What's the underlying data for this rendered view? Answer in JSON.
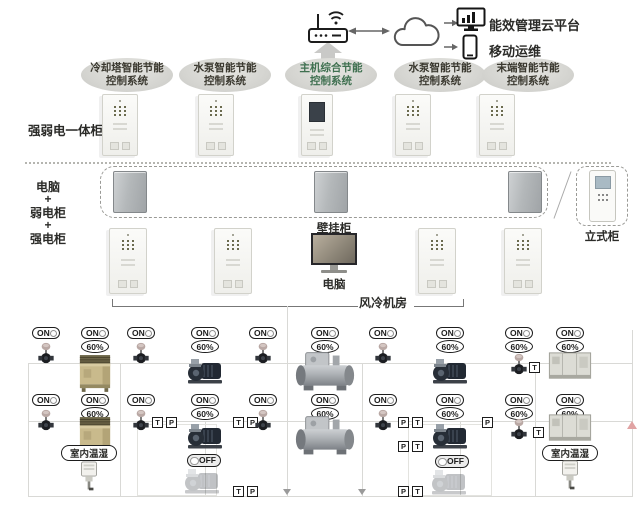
{
  "top": {
    "platform_label": "能效管理云平台",
    "mobile_label": "移动运维"
  },
  "systems": [
    {
      "line1": "冷却塔智能节能",
      "line2": "控制系统"
    },
    {
      "line1": "水泵智能节能",
      "line2": "控制系统"
    },
    {
      "line1": "主机综合节能",
      "line2": "控制系统"
    },
    {
      "line1": "水泵智能节能",
      "line2": "控制系统"
    },
    {
      "line1": "末端智能节能",
      "line2": "控制系统"
    }
  ],
  "labels": {
    "integrated_cabinet": "强弱电一体柜",
    "stack": [
      "电脑",
      "+",
      "弱电柜",
      "+",
      "强电柜"
    ],
    "wall_cabinet": "壁挂柜",
    "computer": "电脑",
    "standing_cabinet": "立式柜",
    "machine_room": "风冷机房"
  },
  "schematic": {
    "row1": [
      {
        "device": "valve",
        "state": "ON"
      },
      {
        "device": "cooling-tower",
        "state": "ON",
        "speed": "60%"
      },
      {
        "device": "valve",
        "state": "ON"
      },
      {
        "device": "pump",
        "state": "ON",
        "speed": "60%"
      },
      {
        "device": "valve",
        "state": "ON"
      },
      {
        "device": "chiller",
        "state": "ON",
        "speed": "60%"
      },
      {
        "device": "valve",
        "state": "ON"
      },
      {
        "device": "pump",
        "state": "ON",
        "speed": "60%"
      },
      {
        "device": "valve",
        "state": "ON",
        "speed": "60%",
        "tags": [
          "T"
        ]
      },
      {
        "device": "ahu",
        "state": "ON",
        "speed": "60%"
      }
    ],
    "row2": [
      {
        "device": "valve",
        "state": "ON"
      },
      {
        "device": "cooling-tower",
        "state": "ON",
        "speed": "60%"
      },
      {
        "device": "valve",
        "state": "ON",
        "tags": [
          "T",
          "P"
        ]
      },
      {
        "device": "pump",
        "state": "ON",
        "speed": "60%",
        "tags": [
          "T",
          "P"
        ]
      },
      {
        "device": "valve",
        "state": "ON"
      },
      {
        "device": "chiller",
        "state": "ON",
        "speed": "60%"
      },
      {
        "device": "valve",
        "state": "ON"
      },
      {
        "device": "pump",
        "state": "ON",
        "speed": "60%",
        "tags_left": [
          "P",
          "T"
        ],
        "tags_right": [
          "P"
        ]
      },
      {
        "device": "valve",
        "state": "ON",
        "speed": "60%",
        "tags": [
          "T"
        ]
      },
      {
        "device": "ahu",
        "state": "ON",
        "speed": "60%"
      }
    ],
    "row3": {
      "left_sensor": "室内温湿",
      "left_pump": {
        "device": "pump",
        "state": "OFF",
        "tags": [
          "T",
          "P"
        ]
      },
      "right_pump": {
        "device": "pump",
        "state": "OFF",
        "tags_top": [
          "P",
          "T"
        ],
        "tags_bottom": [
          "P",
          "T"
        ]
      },
      "right_sensor": "室内温湿"
    }
  },
  "colors": {
    "oval_fill": "#d5d5d1",
    "green_label": "#3f7050",
    "tower": "#c9ba8c",
    "pump_dark": "#222933",
    "chiller_silver": "#a9adb1",
    "pipe_line": "#d9d9d6",
    "badge_border": "#1d1d1d",
    "pink_arrow": "#e0a3a3"
  }
}
